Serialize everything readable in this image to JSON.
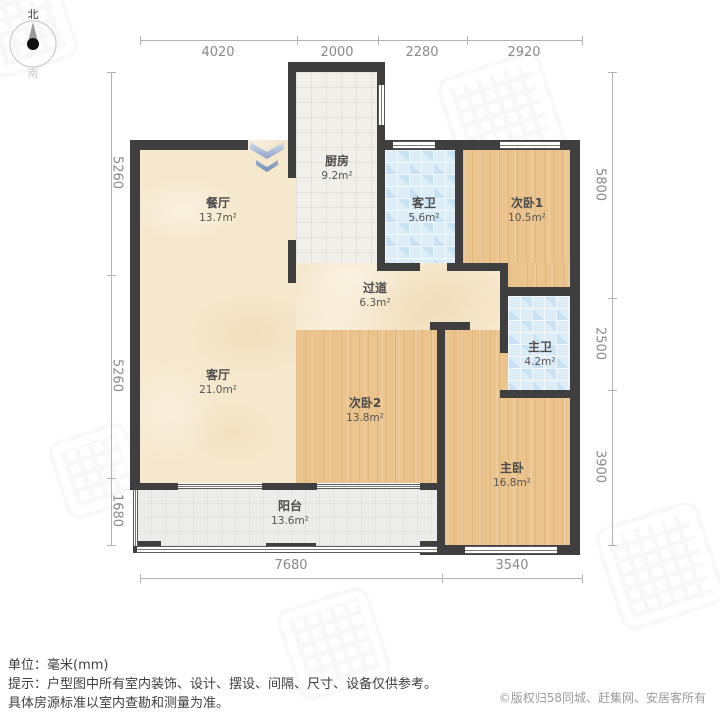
{
  "compass": {
    "north": "北",
    "south": "南"
  },
  "rooms": {
    "dining": {
      "name": "餐厅",
      "area": "13.7m²"
    },
    "kitchen": {
      "name": "厨房",
      "area": "9.2m²"
    },
    "guest_bath": {
      "name": "客卫",
      "area": "5.6m²"
    },
    "bedroom1": {
      "name": "次卧1",
      "area": "10.5m²"
    },
    "corridor": {
      "name": "过道",
      "area": "6.3m²"
    },
    "living": {
      "name": "客厅",
      "area": "21.0m²"
    },
    "bedroom2": {
      "name": "次卧2",
      "area": "13.8m²"
    },
    "master_bath": {
      "name": "主卫",
      "area": "4.2m²"
    },
    "master_bedroom": {
      "name": "主卧",
      "area": "16.8m²"
    },
    "balcony": {
      "name": "阳台",
      "area": "13.6m²"
    }
  },
  "dimensions": {
    "top": [
      "4020",
      "2000",
      "2280",
      "2920"
    ],
    "left": [
      "5260",
      "5260",
      "1680"
    ],
    "right": [
      "5800",
      "2500",
      "3900"
    ],
    "bottom": [
      "7680",
      "3540"
    ]
  },
  "footer": {
    "unit_label": "单位：毫米(mm)",
    "tip_line1": "提示：户型图中所有室内装饰、设计、摆设、间隔、尺寸、设备仅供参考。",
    "tip_line2": "具体房源标准以室内查勘和测量为准。",
    "copyright": "©版权归58同城、赶集网、安居客所有"
  },
  "colors": {
    "wall": "#3f3f3f",
    "floor_marble": "#f6e8cd",
    "floor_wood": "#ebc38c",
    "floor_bath_tile": "#dcedf8",
    "floor_kitchen_tile": "#f0efe9",
    "floor_balcony": "#ececE8",
    "entrance_arrow": "#8aa3c6",
    "dimension_text": "#8a8a8a"
  }
}
